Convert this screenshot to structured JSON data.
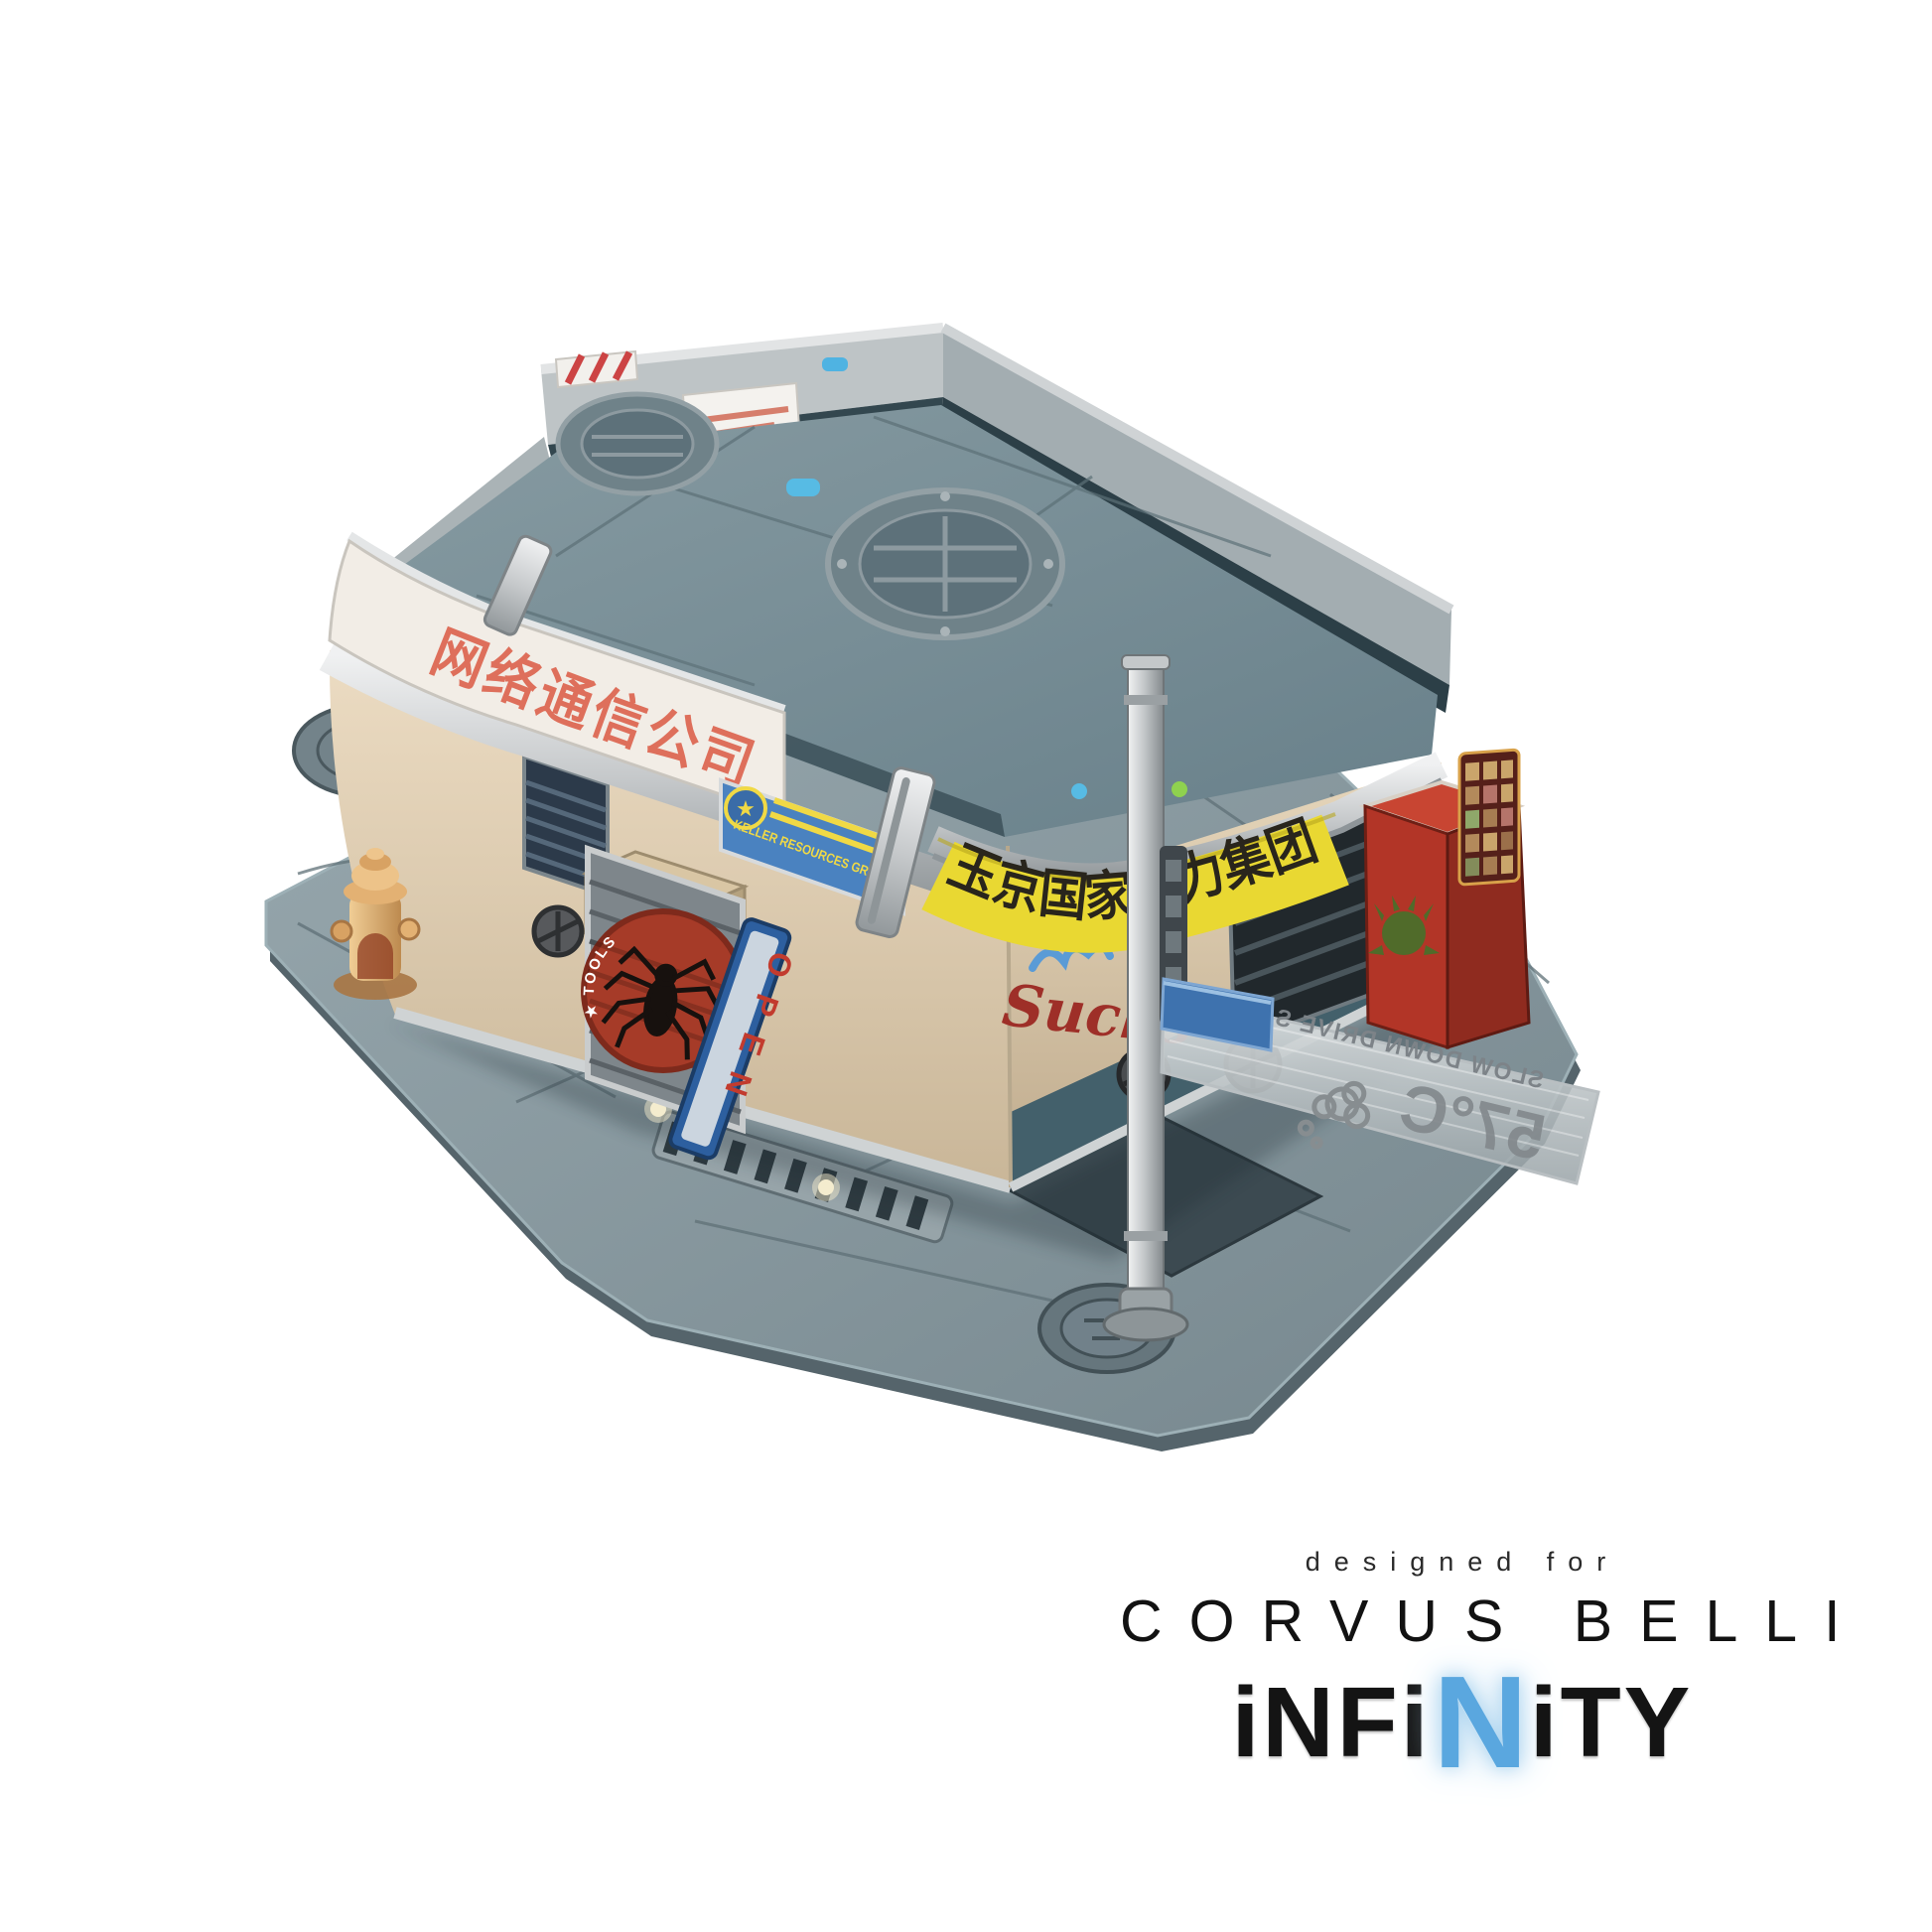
{
  "scene": {
    "type": "product-photo",
    "subject": "Cyberpunk corner-building miniature terrain piece on a sci-fi street base, white studio background",
    "background": "#ffffff"
  },
  "signs": {
    "corner_band": {
      "text": "网络通信公司",
      "color": "#de6f5b",
      "bg": "#f2ede6"
    },
    "keller_banner": {
      "text": "KELLER RESOURCES GROUP",
      "emblem_glyph": "★",
      "bg": "#4a82c0",
      "color": "#f0d945"
    },
    "power_banner": {
      "text": "玉京国家电力集团",
      "bg": "#e9d832",
      "color": "#29251c"
    },
    "open_sign": {
      "text": "OPEN",
      "color": "#c23b2e",
      "frame": "#2d5f9f"
    },
    "spider_door": {
      "arc_text": "★ TOOLS ★",
      "emblem": "spider",
      "circle_color": "#a63b28"
    },
    "graffiti": {
      "text": "Sucks",
      "color": "#9e2f28"
    },
    "street_sign": {
      "line1": "SLOW DOWN DRIVE SAFE",
      "line2": "57°C",
      "mirrored": true
    }
  },
  "palette": {
    "plate": "#8a9aa0",
    "roof": "#7c939b",
    "wall": "#e2d4bd",
    "rail_silver": "#d8d9da",
    "hydrant": "#dca96f",
    "vending_machine": "#b23527",
    "led_green": "#8fd14f",
    "led_blue": "#57bbe4"
  },
  "branding": {
    "designed_for": "designed for",
    "company": "CORVUS BELLI",
    "product_logo": "INFINITY",
    "logo_letters": {
      "prefix": "iNFi",
      "accent": "N",
      "suffix": "iTY"
    },
    "accent_color": "#7cc0ea"
  }
}
